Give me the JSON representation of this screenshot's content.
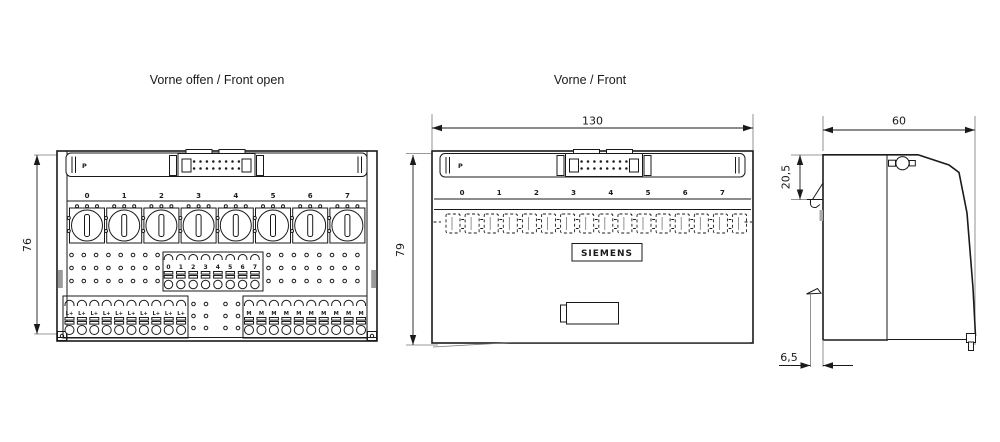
{
  "drawing": {
    "views": {
      "front_open": {
        "title": "Vorne offen / Front open",
        "p_label": "P",
        "channel_numbers": [
          "0",
          "1",
          "2",
          "3",
          "4",
          "5",
          "6",
          "7"
        ],
        "output_terminal_labels": [
          "0",
          "1",
          "2",
          "3",
          "4",
          "5",
          "6",
          "7"
        ],
        "supply_terminal_labels": [
          "L+",
          "L+",
          "L+",
          "L+",
          "L+",
          "L+",
          "L+",
          "L+",
          "L+",
          "L+"
        ],
        "ground_terminal_labels": [
          "M",
          "M",
          "M",
          "M",
          "M",
          "M",
          "M",
          "M",
          "M",
          "M"
        ],
        "height_dim": "76"
      },
      "front": {
        "title": "Vorne / Front",
        "p_label": "P",
        "channel_numbers": [
          "0",
          "1",
          "2",
          "3",
          "4",
          "5",
          "6",
          "7"
        ],
        "brand": "SIEMENS",
        "width_dim": "130",
        "height_dim": "79"
      },
      "side": {
        "width_dim": "60",
        "top_offset_dim": "20,5",
        "bottom_offset_dim": "6,5"
      }
    }
  }
}
